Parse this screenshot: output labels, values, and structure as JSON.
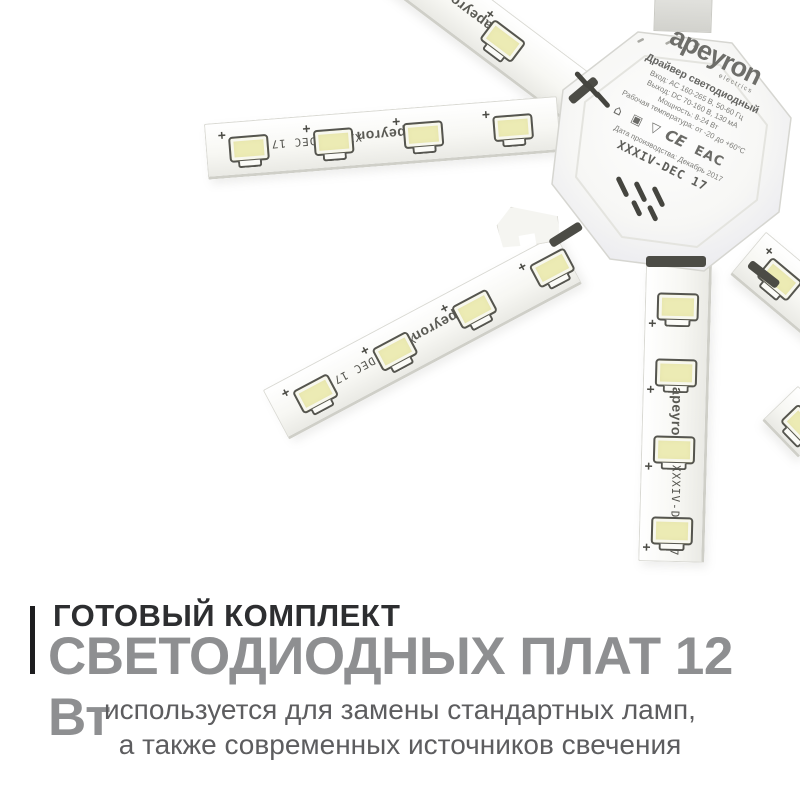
{
  "brand": {
    "logo": "apeyron",
    "logo_sub": "electrics"
  },
  "driver_label": {
    "title": "Драйвер светодиодный",
    "specs": [
      "Вход: AC 160-265 В, 50-60 Гц",
      "Выход: DC 70-160 В, 130 мА",
      "Мощность: 8-24 Вт",
      "Рабочая температура: от -20 до +60°С"
    ],
    "cert_marks": [
      {
        "name": "indoor-use-icon",
        "glyph": "⌂"
      },
      {
        "name": "class-ii-insulation-icon",
        "glyph": "▣"
      },
      {
        "name": "recycling-triangle-icon",
        "glyph": "▽"
      },
      {
        "name": "ce-mark",
        "glyph": "CE"
      },
      {
        "name": "eac-mark",
        "glyph": "EAC"
      }
    ],
    "date": "Дата производства: Декабрь 2017",
    "model": "XXXIV-DEC 17"
  },
  "strip_marking": {
    "brand": "apeyron",
    "model": "XXXIV-DEC 17",
    "polarity": "+"
  },
  "caption": {
    "kicker": "ГОТОВЫЙ КОМПЛЕКТ",
    "title": "СВЕТОДИОДНЫХ ПЛАТ 12 Вт",
    "description_line1": "используется для замены стандартных ламп,",
    "description_line2": "а также современных источников свечения",
    "accent_bar_color": "#1d1d1f",
    "kicker_color": "#2d2e30",
    "title_color": "#8e8f91",
    "description_color": "#5d5d5f"
  },
  "colors": {
    "background": "#ffffff",
    "led_fill": "#ecebb4",
    "led_outline": "#55554f",
    "strip_face": "#f7f7f3",
    "driver_shell": "#f2f2ee"
  }
}
